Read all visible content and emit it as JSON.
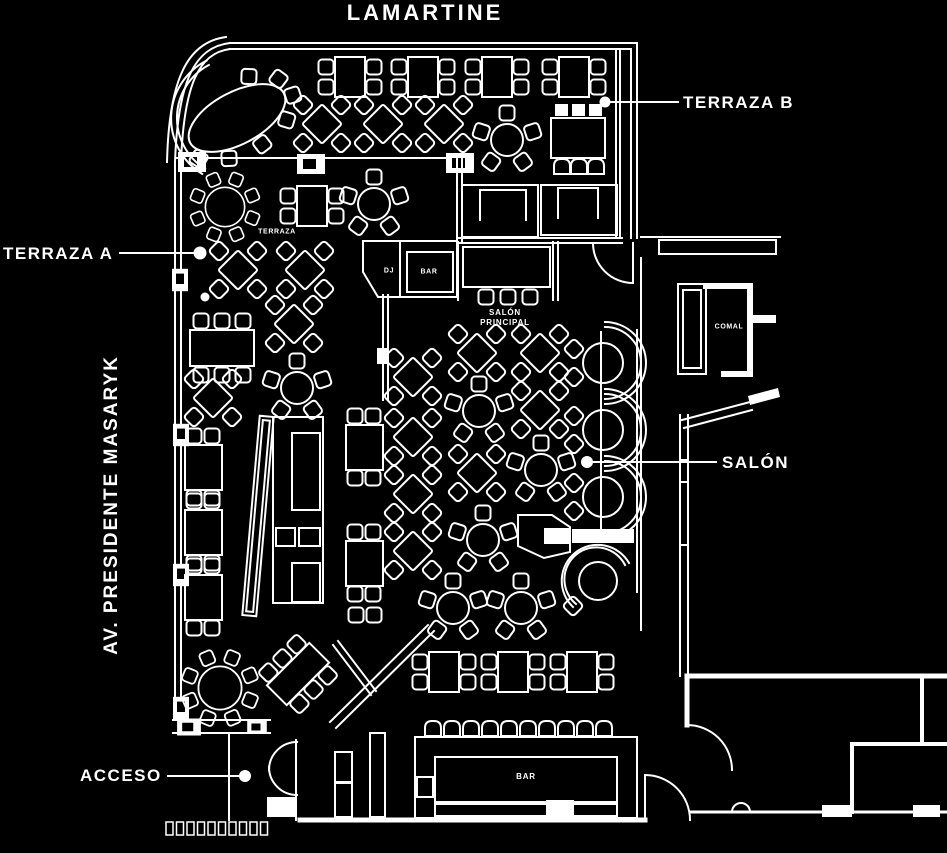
{
  "diagram": {
    "type": "restaurant-floor-plan",
    "colors": {
      "background": "#000000",
      "line": "#ffffff",
      "text": "#ffffff"
    }
  },
  "labels": {
    "top_street": "LAMARTINE",
    "left_street": "AV. PRESIDENTE MASARYK"
  },
  "callouts": {
    "terraza_b": "TERRAZA B",
    "terraza_a": "TERRAZA A",
    "salon": "SALÓN",
    "acceso": "ACCESO"
  },
  "areas": {
    "terraza_small": "TERRAZA",
    "dj": "DJ",
    "bar_upper": "BAR",
    "salon_principal": "SALÓN\nPRINCIPAL",
    "salon_principal_line1": "SALÓN",
    "salon_principal_line2": "PRINCIPAL",
    "comal": "COMAL",
    "bar_lower": "BAR"
  }
}
